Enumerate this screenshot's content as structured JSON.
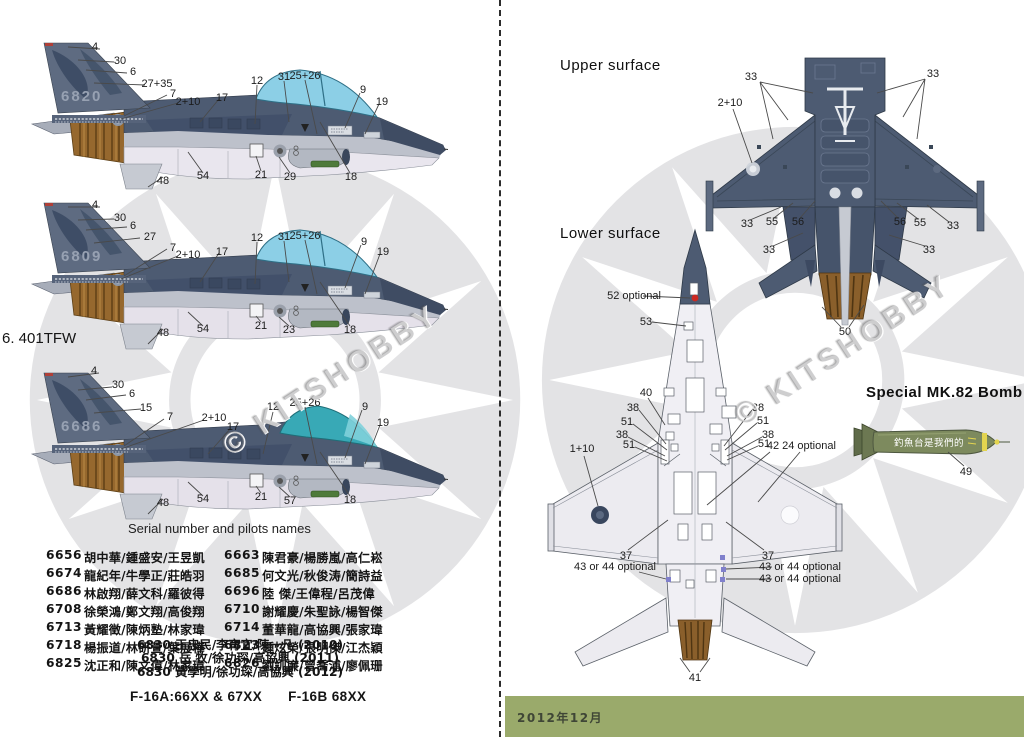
{
  "watermark": {
    "text": "© KITSHOBBY"
  },
  "colors": {
    "camo_dark": "#4d5b72",
    "camo_tail": "#5e6b81",
    "canopy_blue": "#8ccfe6",
    "canopy_teal": "#38a9b6",
    "belly": "#e9e6ee",
    "exhaust_brown": "#8a5f2b",
    "roundel_gray": "#e3e3e5",
    "date_bar_green": "#9aaa6b",
    "bomb_olive": "#7d8a5e"
  },
  "left": {
    "section_label": "6. 401TFW",
    "aircraft": [
      {
        "tail_number": "6820",
        "callouts": [
          {
            "t": "4",
            "x": 67,
            "y": 11
          },
          {
            "t": "30",
            "x": 92,
            "y": 25
          },
          {
            "t": "6",
            "x": 105,
            "y": 36
          },
          {
            "t": "27+35",
            "x": 129,
            "y": 48
          },
          {
            "t": "7",
            "x": 145,
            "y": 58
          },
          {
            "t": "2+10",
            "x": 160,
            "y": 66
          },
          {
            "t": "17",
            "x": 194,
            "y": 62
          },
          {
            "t": "12",
            "x": 229,
            "y": 45
          },
          {
            "t": "31",
            "x": 256,
            "y": 41
          },
          {
            "t": "25+26",
            "x": 277,
            "y": 40
          },
          {
            "t": "9",
            "x": 335,
            "y": 54
          },
          {
            "t": "19",
            "x": 354,
            "y": 66
          },
          {
            "t": "48",
            "x": 135,
            "y": 145
          },
          {
            "t": "54",
            "x": 175,
            "y": 140
          },
          {
            "t": "21",
            "x": 233,
            "y": 139
          },
          {
            "t": "29",
            "x": 262,
            "y": 141
          },
          {
            "t": "18",
            "x": 323,
            "y": 141
          }
        ]
      },
      {
        "tail_number": "6809",
        "callouts": [
          {
            "t": "4",
            "x": 67,
            "y": 9
          },
          {
            "t": "30",
            "x": 92,
            "y": 22
          },
          {
            "t": "6",
            "x": 105,
            "y": 30
          },
          {
            "t": "27",
            "x": 122,
            "y": 41
          },
          {
            "t": "7",
            "x": 145,
            "y": 52
          },
          {
            "t": "2+10",
            "x": 160,
            "y": 59
          },
          {
            "t": "17",
            "x": 194,
            "y": 56
          },
          {
            "t": "12",
            "x": 229,
            "y": 42
          },
          {
            "t": "31",
            "x": 256,
            "y": 41
          },
          {
            "t": "25+26",
            "x": 277,
            "y": 40
          },
          {
            "t": "9",
            "x": 336,
            "y": 46
          },
          {
            "t": "19",
            "x": 355,
            "y": 56
          },
          {
            "t": "48",
            "x": 135,
            "y": 137
          },
          {
            "t": "54",
            "x": 175,
            "y": 133
          },
          {
            "t": "21",
            "x": 233,
            "y": 130
          },
          {
            "t": "23",
            "x": 261,
            "y": 134
          },
          {
            "t": "18",
            "x": 322,
            "y": 134
          }
        ]
      },
      {
        "tail_number": "6686",
        "callouts": [
          {
            "t": "4",
            "x": 66,
            "y": 5
          },
          {
            "t": "30",
            "x": 90,
            "y": 19
          },
          {
            "t": "6",
            "x": 104,
            "y": 28
          },
          {
            "t": "15",
            "x": 118,
            "y": 42
          },
          {
            "t": "7",
            "x": 142,
            "y": 51
          },
          {
            "t": "2+10",
            "x": 186,
            "y": 52
          },
          {
            "t": "17",
            "x": 205,
            "y": 61
          },
          {
            "t": "12",
            "x": 245,
            "y": 41
          },
          {
            "t": "25+26",
            "x": 277,
            "y": 37
          },
          {
            "t": "9",
            "x": 337,
            "y": 41
          },
          {
            "t": "19",
            "x": 355,
            "y": 57
          },
          {
            "t": "48",
            "x": 135,
            "y": 137
          },
          {
            "t": "54",
            "x": 175,
            "y": 133
          },
          {
            "t": "21",
            "x": 233,
            "y": 131
          },
          {
            "t": "57",
            "x": 262,
            "y": 135
          },
          {
            "t": "18",
            "x": 322,
            "y": 134
          }
        ]
      }
    ],
    "serials": {
      "heading": "Serial number and pilots names",
      "rows": [
        [
          "6656",
          "胡中華/鍾盛安/王昱凱",
          "6663",
          "陳君豪/楊勝嵐/高仁崧"
        ],
        [
          "6674",
          "龍紀年/牛學正/莊皓羽",
          "6685",
          "何文光/秋俊涛/簡詩益"
        ],
        [
          "6686",
          "林啟翔/薛文科/羅彼得",
          "6696",
          "陸  傑/王偉程/呂茂偉"
        ],
        [
          "6708",
          "徐榮鴻/鄭文翔/高俊翔",
          "6710",
          "謝耀慶/朱聖詠/楊智傑"
        ],
        [
          "6713",
          "黃耀徵/陳炳塾/林家瑋",
          "6714",
          "董華龍/高協興/張家瑋"
        ],
        [
          "6718",
          "楊振道/林研萱/葉展樺",
          "6823",
          "鍾炫榮/張明傑/江杰穎"
        ],
        [
          "6825",
          "沈正和/陳文偉/林家瑋",
          "6826",
          "劉訓廉/曾喬浦/廖佩珊"
        ]
      ],
      "extra_rows": [
        "6830 王忠民/李育宜/陳一凡 (2010)",
        "6830 岳  牧/徐功琛/高協興 (2011)",
        "6830 黃學明/徐功琛/高協興 (2012)"
      ],
      "footer": {
        "left": "F-16A:66XX & 67XX",
        "right": "F-16B 68XX"
      }
    }
  },
  "right": {
    "upper_label": "Upper surface",
    "lower_label": "Lower surface",
    "upper_callouts": [
      {
        "t": "33",
        "x": 86,
        "y": 22
      },
      {
        "t": "33",
        "x": 268,
        "y": 19
      },
      {
        "t": "2+10",
        "x": 65,
        "y": 48
      },
      {
        "t": "33",
        "x": 82,
        "y": 169
      },
      {
        "t": "55",
        "x": 107,
        "y": 167
      },
      {
        "t": "56",
        "x": 133,
        "y": 167
      },
      {
        "t": "56",
        "x": 235,
        "y": 167
      },
      {
        "t": "55",
        "x": 255,
        "y": 168
      },
      {
        "t": "33",
        "x": 288,
        "y": 171
      },
      {
        "t": "33",
        "x": 104,
        "y": 195
      },
      {
        "t": "33",
        "x": 264,
        "y": 195
      },
      {
        "t": "50",
        "x": 180,
        "y": 277
      }
    ],
    "lower_callouts": [
      {
        "t": "52 optional",
        "x": 94,
        "y": 68
      },
      {
        "t": "53",
        "x": 106,
        "y": 94
      },
      {
        "t": "40",
        "x": 106,
        "y": 165
      },
      {
        "t": "38",
        "x": 93,
        "y": 180
      },
      {
        "t": "51",
        "x": 87,
        "y": 194
      },
      {
        "t": "38",
        "x": 82,
        "y": 207
      },
      {
        "t": "51",
        "x": 89,
        "y": 217
      },
      {
        "t": "1+10",
        "x": 42,
        "y": 221
      },
      {
        "t": "38",
        "x": 218,
        "y": 180
      },
      {
        "t": "51",
        "x": 223,
        "y": 193
      },
      {
        "t": "38",
        "x": 228,
        "y": 207
      },
      {
        "t": "51",
        "x": 224,
        "y": 216
      },
      {
        "t": "42",
        "x": 233,
        "y": 218
      },
      {
        "t": "24 optional",
        "x": 269,
        "y": 218
      },
      {
        "t": "37",
        "x": 86,
        "y": 328
      },
      {
        "t": "43 or 44 optional",
        "x": 75,
        "y": 339
      },
      {
        "t": "37",
        "x": 228,
        "y": 328
      },
      {
        "t": "43 or 44 optional",
        "x": 260,
        "y": 339
      },
      {
        "t": "43 or 44 optional",
        "x": 260,
        "y": 351
      },
      {
        "t": "41",
        "x": 155,
        "y": 450
      }
    ],
    "bomb": {
      "label": "Special MK.82 Bomb",
      "slogan": "釣魚台是我們的",
      "callouts": [
        {
          "t": "49",
          "x": 118,
          "y": 60
        }
      ]
    },
    "date_bar": {
      "text": "2012年12月",
      "color": "#9aaa6b"
    }
  }
}
